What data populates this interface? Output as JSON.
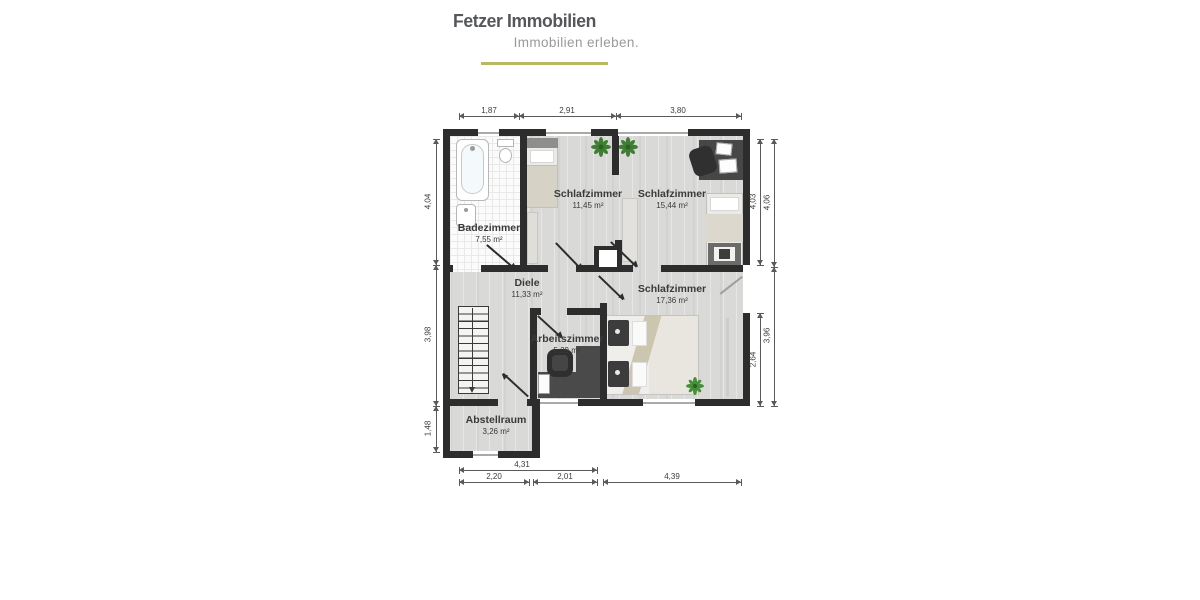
{
  "brand": {
    "title": "Fetzer Immobilien",
    "tagline": "Immobilien erleben.",
    "accent_color": "#b6ba62"
  },
  "floorplan": {
    "rooms": [
      {
        "id": "badezimmer",
        "name": "Badezimmer",
        "area": "7,55 m²"
      },
      {
        "id": "schlafzimmer-1",
        "name": "Schlafzimmer",
        "area": "11,45 m²"
      },
      {
        "id": "schlafzimmer-2",
        "name": "Schlafzimmer",
        "area": "15,44 m²"
      },
      {
        "id": "diele",
        "name": "Diele",
        "area": "11,33 m²"
      },
      {
        "id": "schlafzimmer-3",
        "name": "Schlafzimmer",
        "area": "17,36 m²"
      },
      {
        "id": "arbeitszimmer",
        "name": "Arbeitszimmer",
        "area": "5,29 m²"
      },
      {
        "id": "abstellraum",
        "name": "Abstellraum",
        "area": "3,26 m²"
      }
    ],
    "dimensions": {
      "top": [
        "1,87",
        "2,91",
        "3,80"
      ],
      "left": [
        "4,04",
        "3,98",
        "1,48"
      ],
      "right_inner": [
        "4,03",
        "2,64"
      ],
      "right_outer": [
        "4,06",
        "3,96"
      ],
      "bottom_total": "4,31",
      "bottom": [
        "2,20",
        "2,01",
        "4,39"
      ]
    },
    "colors": {
      "wall": "#2d2d2d",
      "floor": "#d9d9d7",
      "accent": "#b6ba62"
    }
  }
}
